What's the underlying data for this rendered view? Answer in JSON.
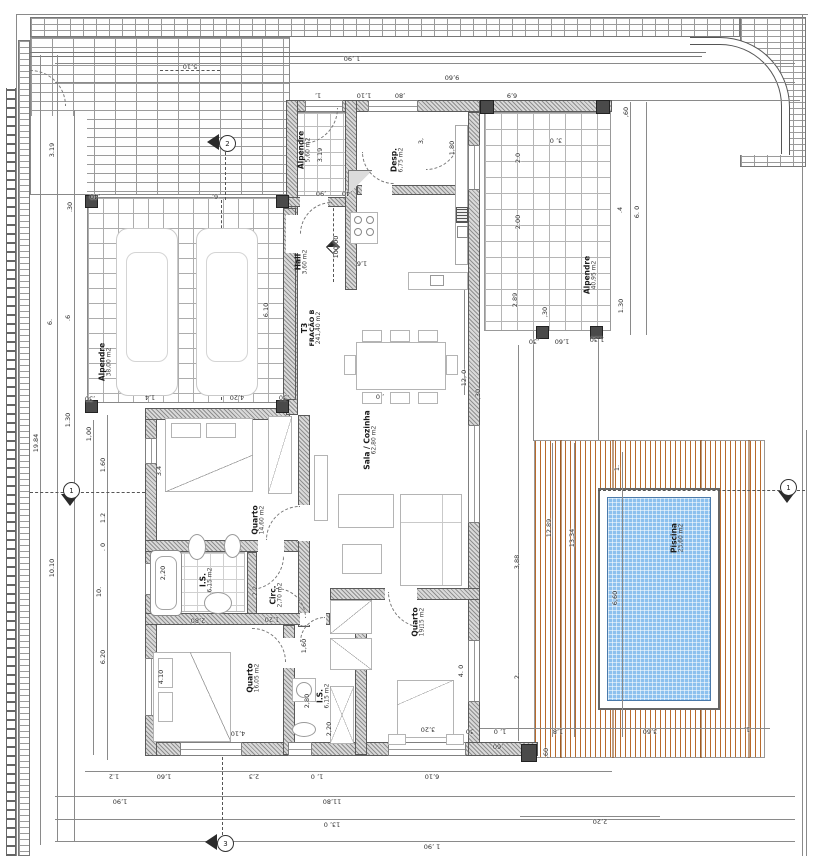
{
  "drawing": {
    "type_label": "floor-plan",
    "level_mark": "100.00",
    "colors": {
      "wall_gray": "#8f8f8f",
      "deck_wood": "#b76a2c",
      "pool_blue": "#8cc0ee",
      "line": "#5a5a5a"
    }
  },
  "rooms": [
    {
      "id": "alpendre-carport",
      "name": "Alpendre",
      "area": "38,00 m2",
      "x": 106,
      "y": 362
    },
    {
      "id": "alpendre-entry",
      "name": "Alpendre",
      "area": "5,60 m2",
      "x": 305,
      "y": 150
    },
    {
      "id": "despensa",
      "name": "Desp.",
      "area": "6,75 m2",
      "x": 398,
      "y": 160
    },
    {
      "id": "hall",
      "name": "Hall",
      "area": "3,60 m2",
      "x": 302,
      "y": 262
    },
    {
      "id": "fracao",
      "name": "T3",
      "sub": "FRAÇÃO B",
      "area": "241,40 m2",
      "x": 312,
      "y": 328
    },
    {
      "id": "sala-cozinha",
      "name": "Sala / Cozinha",
      "area": "62,80 m2",
      "x": 371,
      "y": 440
    },
    {
      "id": "quarto-1",
      "name": "Quarto",
      "area": "14,60 m2",
      "x": 259,
      "y": 520
    },
    {
      "id": "is-1",
      "name": "I.S.",
      "area": "6,15 m2",
      "x": 207,
      "y": 580
    },
    {
      "id": "circ",
      "name": "Circ.",
      "area": "2,70 m2",
      "x": 277,
      "y": 595
    },
    {
      "id": "quarto-2",
      "name": "Quarto",
      "area": "16,05 m2",
      "x": 254,
      "y": 678
    },
    {
      "id": "is-2",
      "name": "I.S.",
      "area": "6,15 m2",
      "x": 324,
      "y": 696
    },
    {
      "id": "quarto-3",
      "name": "Quarto",
      "area": "19,15 m2",
      "x": 419,
      "y": 622
    },
    {
      "id": "alpendre-right",
      "name": "Alpendre",
      "area": "40,95 m2",
      "x": 591,
      "y": 275
    },
    {
      "id": "piscina",
      "name": "Piscina",
      "area": "23,60 m2",
      "x": 678,
      "y": 538
    }
  ],
  "dims": [
    [
      "1 ,90",
      352,
      58,
      180
    ],
    [
      "9,60",
      452,
      77,
      180
    ],
    [
      "5,10",
      190,
      66,
      180
    ],
    [
      "1,",
      318,
      95,
      180
    ],
    [
      "1,10",
      364,
      95,
      180
    ],
    [
      ",80",
      400,
      95,
      180
    ],
    [
      "6,9",
      512,
      95,
      180
    ],
    [
      ",60",
      626,
      112,
      -90
    ],
    [
      "19.84",
      36,
      443,
      -90
    ],
    [
      "3.19",
      52,
      150,
      -90
    ],
    [
      "10.10",
      52,
      568,
      -90
    ],
    [
      ".30",
      70,
      207,
      -90
    ],
    [
      "6.",
      50,
      322,
      -90
    ],
    [
      ".6",
      68,
      318,
      -90
    ],
    [
      "1.30",
      68,
      420,
      -90
    ],
    [
      "1,00",
      89,
      434,
      -90
    ],
    [
      "1.60",
      103,
      465,
      -90
    ],
    [
      "1.2",
      103,
      518,
      -90
    ],
    [
      ". 0",
      103,
      547,
      -90
    ],
    [
      "10.",
      99,
      592,
      -90
    ],
    [
      "6.20",
      103,
      657,
      -90
    ],
    [
      ",40",
      95,
      196,
      180
    ],
    [
      "6,",
      215,
      196,
      180
    ],
    [
      "6.10",
      266,
      310,
      -90
    ],
    [
      ",30",
      90,
      398,
      180
    ],
    [
      "1,4",
      150,
      397,
      180
    ],
    [
      "4,20",
      237,
      397,
      180
    ],
    [
      ",30",
      284,
      397,
      180
    ],
    [
      "3.19",
      320,
      155,
      -90
    ],
    [
      ",90",
      321,
      193,
      180
    ],
    [
      ",40",
      347,
      193,
      180
    ],
    [
      "1,80",
      452,
      148,
      -90
    ],
    [
      "3,",
      421,
      141,
      -90
    ],
    [
      "100.00",
      336,
      247,
      -90
    ],
    [
      "1,6",
      362,
      263,
      180
    ],
    [
      "12, 0",
      464,
      378,
      -90
    ],
    [
      ", 0",
      380,
      396,
      180
    ],
    [
      ",30",
      478,
      394,
      -90
    ],
    [
      "3, 0",
      556,
      140,
      180
    ],
    [
      "2.0",
      518,
      158,
      -90
    ],
    [
      "2.00",
      518,
      222,
      -90
    ],
    [
      "2.89",
      515,
      300,
      -90
    ],
    [
      ".4",
      620,
      210,
      -90
    ],
    [
      "6. 0",
      637,
      212,
      -90
    ],
    [
      "1.30",
      621,
      306,
      -90
    ],
    [
      ",30",
      545,
      312,
      -90
    ],
    [
      ",30",
      534,
      341,
      180
    ],
    [
      "1,60",
      562,
      341,
      180
    ],
    [
      "1,30",
      597,
      339,
      180
    ],
    [
      "12.89",
      549,
      528,
      -90
    ],
    [
      "13.34",
      572,
      538,
      -90
    ],
    [
      "1.",
      617,
      468,
      -90
    ],
    [
      "6,60",
      615,
      598,
      -90
    ],
    [
      "3,88",
      517,
      562,
      -90
    ],
    [
      "2.",
      517,
      676,
      -90
    ],
    [
      "1,8",
      558,
      731,
      180
    ],
    [
      "3,60",
      650,
      731,
      180
    ],
    [
      "1,",
      747,
      729,
      180
    ],
    [
      ",60",
      498,
      746,
      180
    ],
    [
      ",60",
      546,
      753,
      -90
    ],
    [
      "30",
      470,
      731,
      180
    ],
    [
      "1, 0",
      500,
      731,
      180
    ],
    [
      "2,20",
      600,
      821,
      180
    ],
    [
      "3.4",
      159,
      471,
      -90
    ],
    [
      "2,20",
      163,
      573,
      -90
    ],
    [
      "2.2",
      255,
      591,
      -90
    ],
    [
      "2,80",
      198,
      620,
      180
    ],
    [
      "1,20",
      272,
      619,
      180
    ],
    [
      "1,60",
      304,
      646,
      -90
    ],
    [
      "4.10",
      161,
      677,
      -90
    ],
    [
      "4,10",
      238,
      733,
      180
    ],
    [
      "2,80",
      307,
      701,
      -90
    ],
    [
      "2,20",
      329,
      729,
      -90
    ],
    [
      "3,20",
      428,
      729,
      180
    ],
    [
      "4. 0",
      461,
      671,
      -90
    ],
    [
      "6,10",
      432,
      776,
      180
    ],
    [
      "1.2",
      114,
      776,
      180
    ],
    [
      "1,60",
      164,
      776,
      180
    ],
    [
      "2,3",
      254,
      776,
      180
    ],
    [
      "1, 0",
      317,
      776,
      180
    ],
    [
      "1,90",
      120,
      801,
      180
    ],
    [
      "11,80",
      332,
      801,
      180
    ],
    [
      "13, 0",
      332,
      824,
      180
    ],
    [
      "1 ,90",
      432,
      846,
      180
    ]
  ],
  "markers": [
    {
      "label": "2",
      "x": 222,
      "y": 143,
      "dir": "left"
    },
    {
      "label": "1",
      "x": 71,
      "y": 495,
      "dir": "down"
    },
    {
      "label": "1",
      "x": 788,
      "y": 492,
      "dir": "down"
    },
    {
      "label": "3",
      "x": 220,
      "y": 843,
      "dir": "left"
    }
  ]
}
